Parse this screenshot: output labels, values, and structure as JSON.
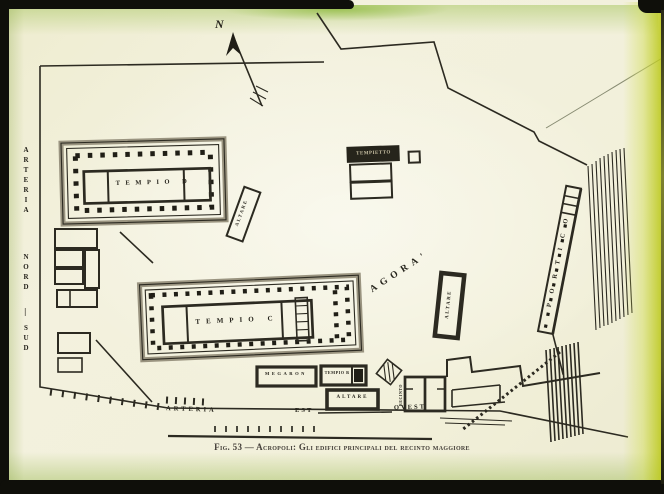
{
  "figure": {
    "caption": "Fig. 53 — Acropoli: Gli edifici principali del recinto maggiore"
  },
  "compass": {
    "label": "N"
  },
  "streets": {
    "north_south": {
      "name": "ARTERIA",
      "dir1": "NORD",
      "dash": "—",
      "dir2": "SUD"
    },
    "east_west": {
      "name": "ARTERIA",
      "dir1": "EST",
      "dir2": "OVEST"
    }
  },
  "places": {
    "agora": {
      "label": "AGORA'"
    },
    "temple_d": {
      "label": "TEMPIO D"
    },
    "temple_c": {
      "label": "TEMPIO C"
    },
    "temple_b": {
      "label": "TEMPIO B"
    },
    "megaron": {
      "label": "MEGARON"
    },
    "small_shrine": {
      "label": "TEMPIETTO"
    },
    "portico": {
      "label": "PORTICO"
    },
    "altar_temple_d": {
      "label": "ALTARE"
    },
    "altar_agora": {
      "label": "ALTARE"
    },
    "altar_south": {
      "label": "ALTARE"
    },
    "precinct": {
      "label": "RECINTO"
    }
  },
  "colors": {
    "paper": "#f2f0da",
    "ink": "#2c2a21",
    "wall_gray": "#9a9480",
    "frame_black": "#0f0f0a",
    "tint_green": "#a8c662",
    "tint_yellow": "#bac714"
  }
}
